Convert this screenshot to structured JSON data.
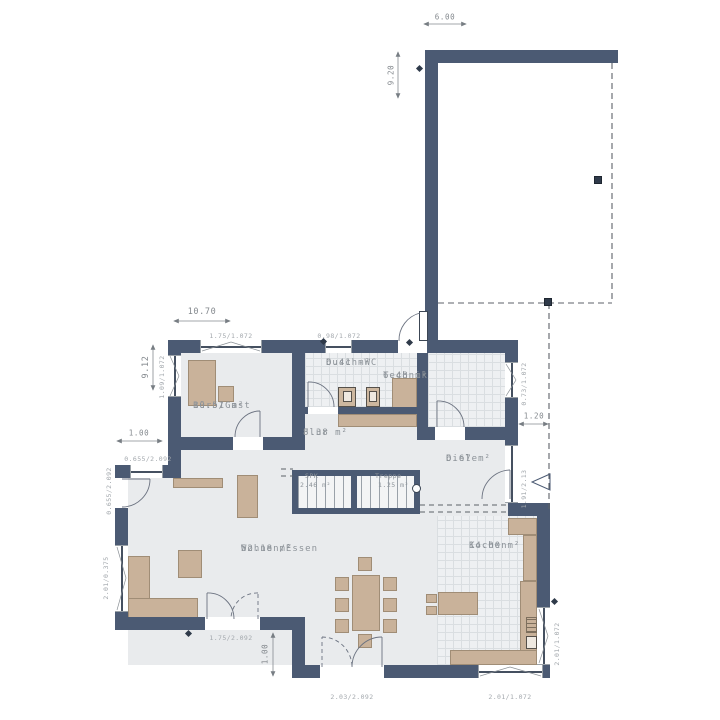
{
  "meta": {
    "type": "architectural-floor-plan",
    "language": "de"
  },
  "colors": {
    "wall": "#4b5a73",
    "floor": "#e9ebed",
    "tile_floor": "#eef0f2",
    "furniture": "#c9b29a",
    "dashed_line": "#5c6268",
    "dimension_text": "#84898e",
    "room_text": "#8d9399"
  },
  "rooms": [
    {
      "name": "Büro/Gast",
      "area": "10.51 m²"
    },
    {
      "name": "Dusch-WC",
      "area": "6.41 m²"
    },
    {
      "name": "Technik",
      "area": "6.48 m²"
    },
    {
      "name": "Flur",
      "area": "8.38 m²"
    },
    {
      "name": "Diele",
      "area": "6.67 m²"
    },
    {
      "name": "SPK",
      "area": "2.46 m²"
    },
    {
      "name": "Treppe",
      "area": "1.25 m²"
    },
    {
      "name": "Wohnen/Essen",
      "area": "52.18 m²"
    },
    {
      "name": "Kochen",
      "area": "14.00 m²"
    }
  ],
  "openings": [
    "1.75/1.072",
    "0.98/1.072",
    "1.09/1.072",
    "0.73/1.072",
    "0.655/2.092",
    "0.655/2.092",
    "2.01/0.375",
    "1.75/2.092",
    "2.03/2.092",
    "2.01/1.072",
    "2.01/1.072",
    "1.91/2.13"
  ],
  "dimensions": [
    "6.00",
    "9.20",
    "10.70",
    "9.12",
    "1.00",
    "1.00",
    "1.20"
  ]
}
